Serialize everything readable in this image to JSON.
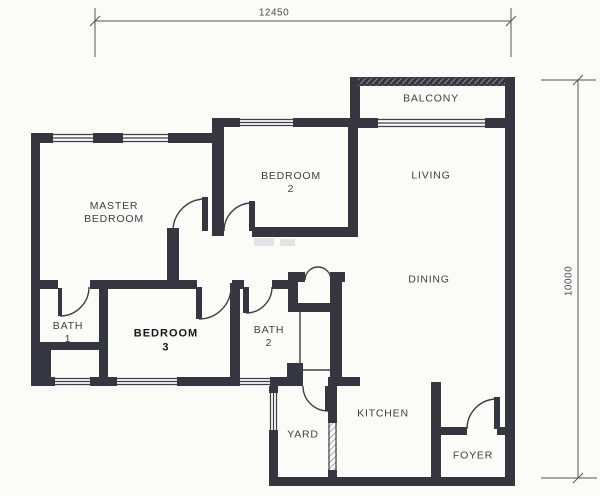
{
  "page": {
    "background_color": "#fbfbf8"
  },
  "plan": {
    "wall_color": "#35363f",
    "line_color": "#3d3e48",
    "dimension_color": "#54555e",
    "dimensions": {
      "top_width": "12450",
      "right_height": "10000"
    },
    "rooms": {
      "master_bedroom": {
        "line1": "MASTER",
        "line2": "BEDROOM"
      },
      "bedroom_2": {
        "line1": "BEDROOM",
        "line2": "2"
      },
      "bedroom_3": {
        "line1": "BEDROOM",
        "line2": "3"
      },
      "bath_1": {
        "line1": "BATH",
        "line2": "1"
      },
      "bath_2": {
        "line1": "BATH",
        "line2": "2"
      },
      "balcony": {
        "line1": "BALCONY"
      },
      "living": {
        "line1": "LIVING"
      },
      "dining": {
        "line1": "DINING"
      },
      "kitchen": {
        "line1": "KITCHEN"
      },
      "yard": {
        "line1": "YARD"
      },
      "foyer": {
        "line1": "FOYER"
      }
    }
  }
}
